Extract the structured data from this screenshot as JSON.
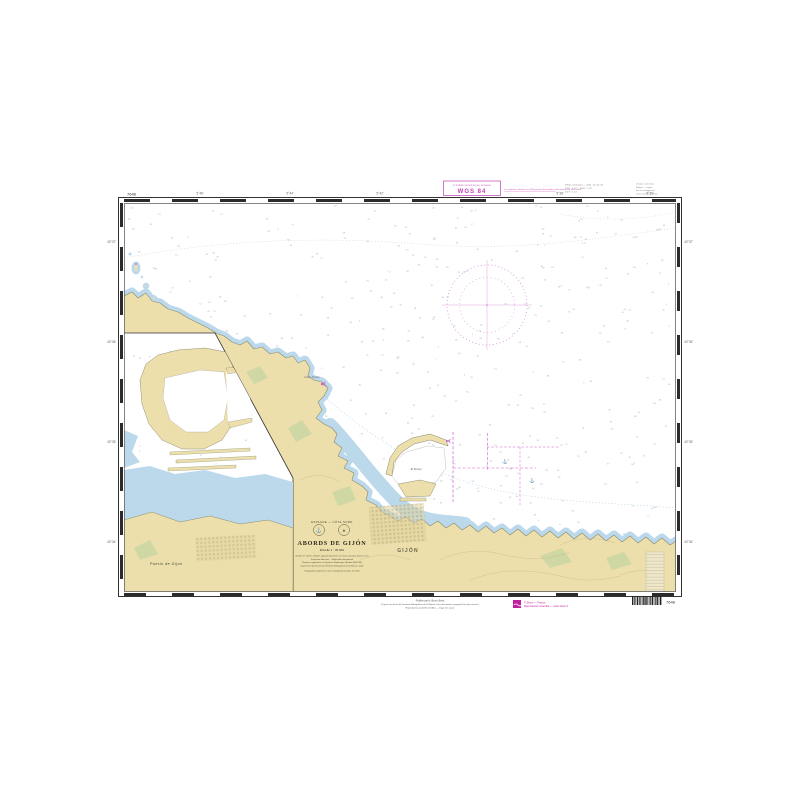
{
  "chart": {
    "number": "7648",
    "title": "ABORDS DE GIJÓN",
    "region_line": "ESPAGNE — CÔTE NORD",
    "scale_line": "Échelle 1 : 30 000",
    "note_lines": [
      "Sondes en mètres réduites approximativement au niveau des plus basses mers",
      "Projection Mercator — Ellipsoïde international",
      "Positions rapportées au Système Géodésique Mondial (WGS 84)",
      "D'après les documents de l'Instituto Hidrográfico de la Marina, Cádiz",
      "Topographie d'après les cartes espagnoles les plus récentes"
    ]
  },
  "datum": {
    "box_caption": "SYSTÈME GÉODÉSIQUE MONDIAL",
    "box_value": "WGS 84",
    "side_note": "Les positions relevées au GPS peuvent être portées directement sur cette carte."
  },
  "margin": {
    "corrections_a": [
      "Petites corrections — 2014 : 12, 31, 45",
      "2015 : 3, 18 — 2016 : 7, 22",
      "2017 : 5, 14"
    ],
    "corrections_b": [
      "Grandes corrections",
      "Éditions — tirages",
      "Voir le catalogue des",
      "cartes marines du Shom"
    ],
    "bottom_notes": [
      "Publiée par le Shom, Brest",
      "D'après les levés de l'Instituto Hidrográfico de la Marina et les documents espagnols les plus récents",
      "Reproduction partielle interdite — tirage mis à jour"
    ],
    "copyright": [
      "© Shom — France",
      "Reproduction interdite — www.shom.fr"
    ],
    "barcode_pattern": "211211122111211212"
  },
  "inset": {
    "label": "Puerto de Gijón"
  },
  "map_labels": [
    {
      "text": "GIJÓN"
    },
    {
      "text": "Cabo Torres"
    },
    {
      "text": "El Musel"
    }
  ],
  "graticule": {
    "top": [
      "5°46'",
      "5°44'",
      "5°42'",
      "5°40'",
      "5°38'",
      "5°36'"
    ],
    "left": [
      "43°37'",
      "43°36'",
      "43°35'",
      "43°34'"
    ]
  },
  "colors": {
    "magenta_accent": "#c23fb4",
    "compass_magenta": "#d583d5",
    "land_tan": "#ecdfab",
    "shallow_blue": "#bcd9ec",
    "green_patch": "#ccd7a4",
    "frame": "#333333",
    "sounding_gray": "#96abc0"
  },
  "soundings": {
    "main": {
      "seed": 7,
      "count": 520,
      "x": 127,
      "y": 206,
      "w": 546,
      "h": 383,
      "size": 2.2,
      "color": "#96abc0",
      "max": 85
    },
    "inset": {
      "seed": 11,
      "count": 90,
      "x": 130,
      "y": 338,
      "w": 158,
      "h": 246,
      "size": 2.2,
      "color": "#96abc0",
      "max": 12
    }
  }
}
